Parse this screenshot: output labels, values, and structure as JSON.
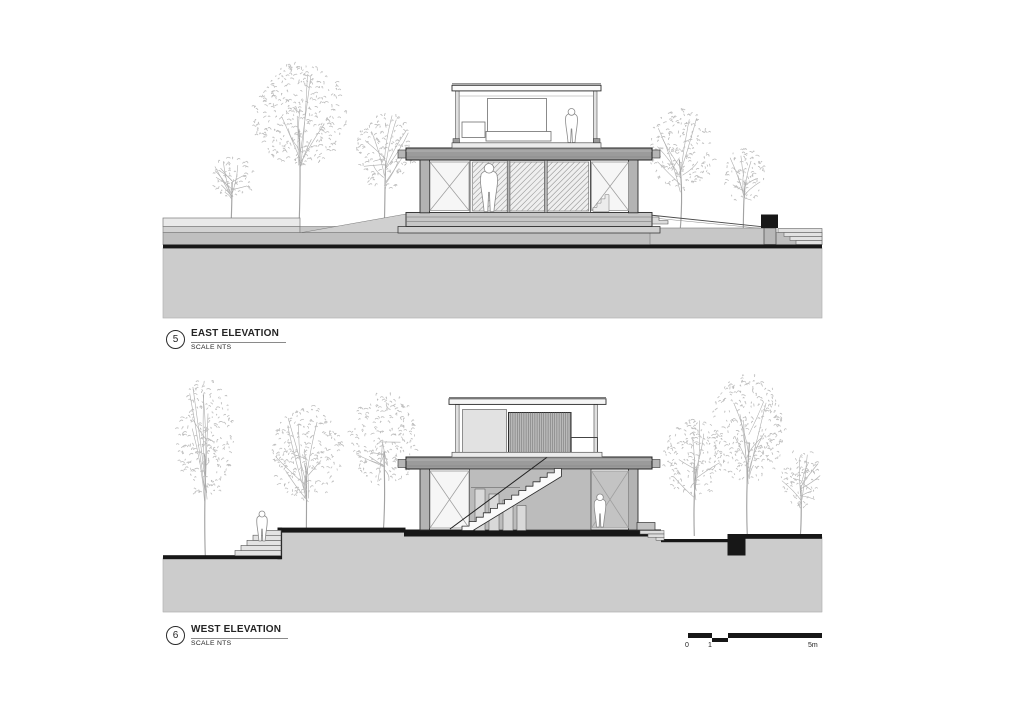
{
  "east_elevation": {
    "number": "5",
    "title": "EAST ELEVATION",
    "scale_note": "SCALE NTS"
  },
  "west_elevation": {
    "number": "6",
    "title": "WEST ELEVATION",
    "scale_note": "SCALE NTS"
  },
  "scale_bar": {
    "labels": [
      "0",
      "1",
      "5m"
    ]
  },
  "colors": {
    "background": "#ffffff",
    "ground_fill": "#cccccc",
    "cut_black": "#171717",
    "slab_gray": "#9b9b9b",
    "deck_gray": "#c6c6c6",
    "band_gray": "#bfbfbf",
    "tree_gray": "#bdbdbd",
    "glass_hatch": "#9b9b9b"
  }
}
